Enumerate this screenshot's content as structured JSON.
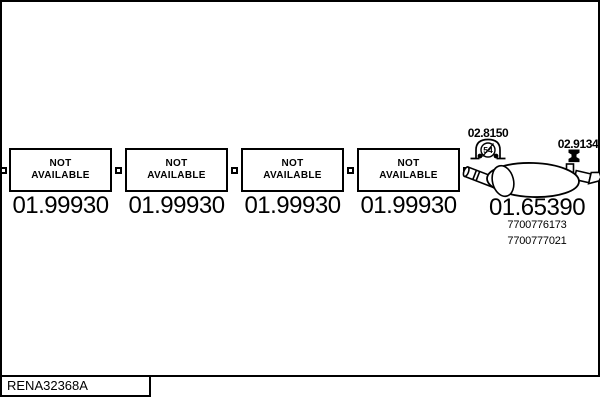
{
  "diagram": {
    "modules": [
      {
        "status_line1": "NOT",
        "status_line2": "AVAILABLE",
        "code": "01.99930"
      },
      {
        "status_line1": "NOT",
        "status_line2": "AVAILABLE",
        "code": "01.99930"
      },
      {
        "status_line1": "NOT",
        "status_line2": "AVAILABLE",
        "code": "01.99930"
      },
      {
        "status_line1": "NOT",
        "status_line2": "AVAILABLE",
        "code": "01.99930"
      }
    ],
    "rear_silencer": {
      "code": "01.65390",
      "oem_numbers": [
        "7700776173",
        "7700777021"
      ],
      "clamp": {
        "code": "02.8150",
        "diameter_label": "54"
      },
      "hanger": {
        "code": "02.9134"
      }
    },
    "footer_reference": "RENA32368A",
    "colors": {
      "line": "#000000",
      "background": "#ffffff"
    }
  }
}
